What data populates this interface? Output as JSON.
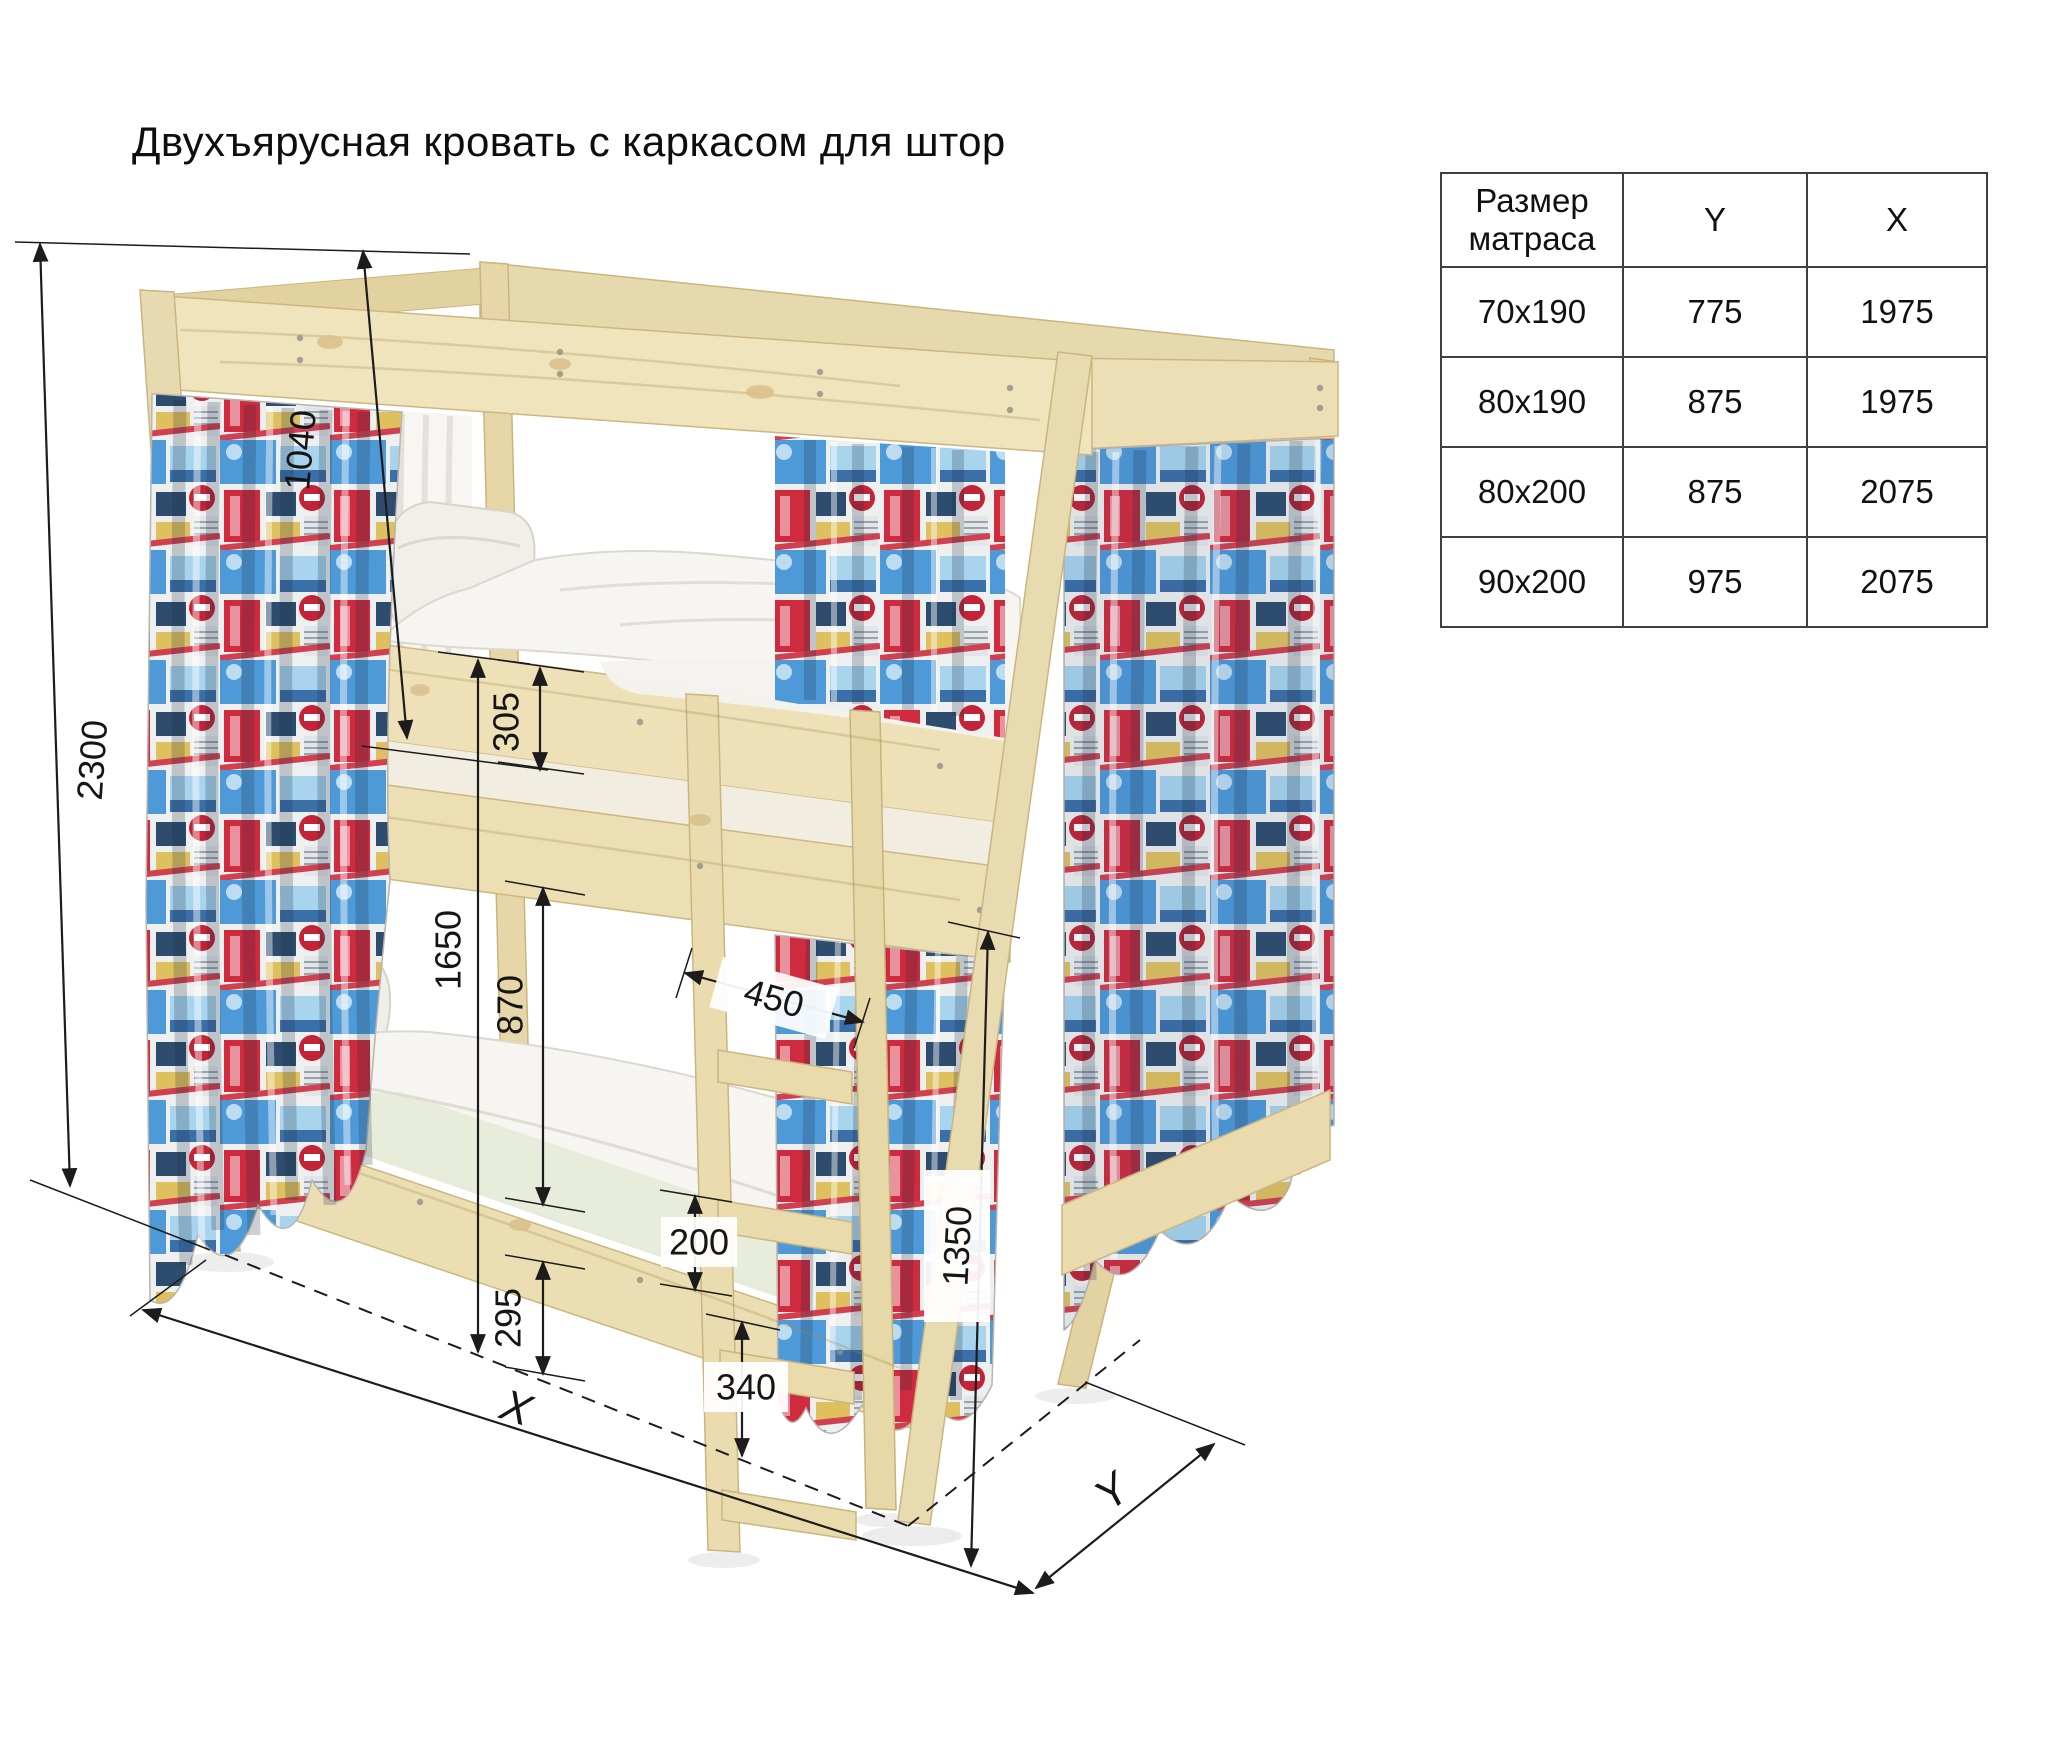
{
  "title": "Двухъярусная кровать с каркасом для штор",
  "table": {
    "headers": [
      "Размер матраса",
      "Y",
      "X"
    ],
    "rows": [
      [
        "70x190",
        "775",
        "1975"
      ],
      [
        "80x190",
        "875",
        "1975"
      ],
      [
        "80x200",
        "875",
        "2075"
      ],
      [
        "90x200",
        "975",
        "2075"
      ]
    ]
  },
  "dimensions": {
    "total_height": "2300",
    "canopy_height": "1040",
    "rail_height": "305",
    "upper_level": "1650",
    "bunk_clearance": "870",
    "under_bed": "295",
    "ladder_width": "450",
    "rung_step": "200",
    "foot_height": "340",
    "side_height": "1350",
    "length_axis": "X",
    "depth_axis": "Y"
  },
  "colors": {
    "wood": "#ecdfb6",
    "wood_edge": "#cdb780",
    "fabric_red": "#cf2b3e",
    "fabric_blue": "#4e9ad8",
    "bedding": "#f6f5f1",
    "line": "#1c1c1c"
  }
}
